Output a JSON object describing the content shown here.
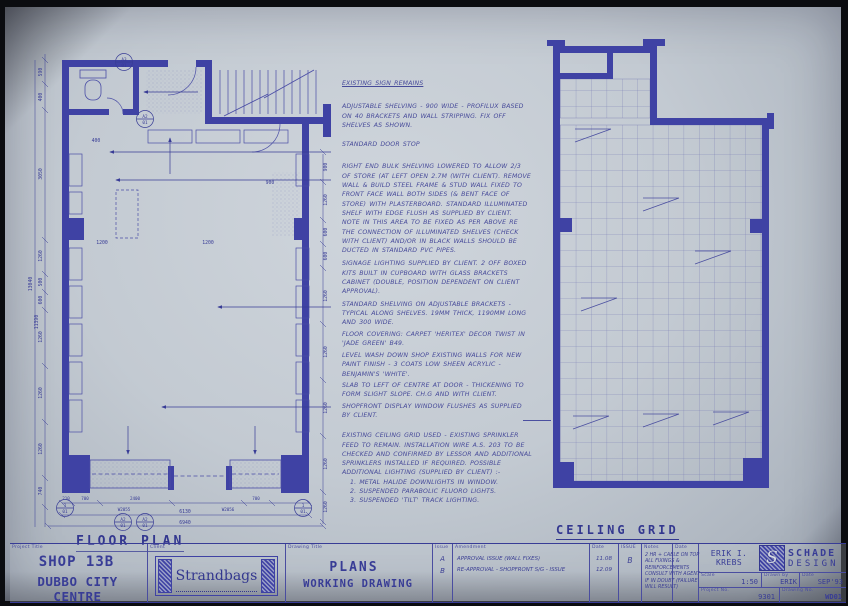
{
  "sheet": {
    "paper_color": "#c3cad2",
    "ink_color": "#383c96",
    "wall_color": "#3f42a4"
  },
  "floor_plan": {
    "title": "FLOOR PLAN",
    "dims_left": [
      "590",
      "400",
      "3050",
      "1260",
      "500",
      "600",
      "1260",
      "1260",
      "1260",
      "740"
    ],
    "dims_left_totals": [
      "13040",
      "11390"
    ],
    "dims_right": [
      "900",
      "1260",
      "600",
      "600",
      "1260",
      "1260",
      "1260",
      "1260",
      "1260"
    ],
    "dims_bottom": [
      "210",
      "700",
      "2400",
      "700"
    ],
    "dims_bottom_totals": [
      "6130",
      "6940"
    ],
    "window_tags": [
      "W2055",
      "W2056"
    ],
    "interior_dims": {
      "d1200a": "1200",
      "d1200b": "1200",
      "d900": "900",
      "d400": "400"
    },
    "ref_tags": {
      "a3": "A3",
      "a2": "A2",
      "one": "1",
      "sheet_no": "01"
    }
  },
  "ceiling_grid": {
    "title": "CEILING GRID"
  },
  "notes": {
    "items": [
      "EXISTING SIGN REMAINS",
      "ADJUSTABLE SHELVING - 900 WIDE - PROFILUX BASED ON 40 BRACKETS AND WALL STRIPPING. FIX OFF SHELVES AS SHOWN.",
      "STANDARD DOOR STOP",
      "RIGHT END BULK SHELVING LOWERED TO ALLOW 2/3 OF STORE (AT LEFT OPEN 2.7M (WITH CLIENT). REMOVE WALL & BUILD STEEL FRAME & STUD WALL FIXED TO FRONT FACE WALL BOTH SIDES (& BENT FACE OF STORE) WITH PLASTERBOARD. STANDARD ILLUMINATED SHELF WITH EDGE FLUSH AS SUPPLIED BY CLIENT. NOTE IN THIS AREA TO BE FIXED AS PER ABOVE RE THE CONNECTION OF ILLUMINATED SHELVES (CHECK WITH CLIENT) AND/OR IN BLACK WALLS SHOULD BE DUCTED IN STANDARD PVC PIPES.",
      "SIGNAGE LIGHTING SUPPLIED BY CLIENT. 2 OFF BOXED KITS BUILT IN CUPBOARD WITH GLASS BRACKETS CABINET (DOUBLE, POSITION DEPENDENT ON CLIENT APPROVAL).",
      "STANDARD SHELVING ON ADJUSTABLE BRACKETS - TYPICAL ALONG SHELVES. 19MM THICK, 1190MM LONG AND 300 WIDE.",
      "FLOOR COVERING: CARPET 'HERITEX' DECOR TWIST IN 'JADE GREEN' B49.",
      "LEVEL WASH DOWN SHOP EXISTING WALLS FOR NEW PAINT FINISH - 3 COATS LOW SHEEN ACRYLIC - BENJAMIN'S 'WHITE'.",
      "SLAB TO LEFT OF CENTRE AT DOOR - THICKENING TO FORM SLIGHT SLOPE. CH.G AND WITH CLIENT.",
      "SHOPFRONT DISPLAY WINDOW FLUSHES AS SUPPLIED BY CLIENT.",
      "EXISTING CEILING GRID USED - EXISTING SPRINKLER FEED TO REMAIN. INSTALLATION WIRE A.S. 203 TO BE CHECKED AND CONFIRMED BY LESSOR AND ADDITIONAL SPRINKLERS INSTALLED IF REQUIRED. POSSIBLE ADDITIONAL LIGHTING (SUPPLIED BY CLIENT) :-",
      "1. METAL HALIDE DOWNLIGHTS IN WINDOW.",
      "2. SUSPENDED PARABOLIC FLUORO LIGHTS.",
      "3. SUSPENDED 'TILT' TRACK LIGHTING."
    ]
  },
  "title_block": {
    "project_title_label": "Project Title",
    "project_title_line1": "SHOP  13B",
    "project_title_line2": "DUBBO CITY CENTRE",
    "client_label": "Client",
    "client_name": "Strandbags",
    "drawing_title_label": "Drawing Title",
    "drawing_title_line1": "PLANS",
    "drawing_title_line2": "WORKING DRAWING",
    "issue_label": "Issue",
    "amendment_label": "Amendment",
    "date_label": "Date",
    "issue2_label": "ISSUE",
    "notes_label": "Notes",
    "date2_label": "Date",
    "revisions": [
      {
        "issue": "A",
        "amendment": "APPROVAL ISSUE (WALL FIXES)",
        "date": "11.08"
      },
      {
        "issue": "B",
        "amendment": "RE-APPROVAL - SHOPFRONT S/G - ISSUE",
        "date": "12.09"
      }
    ],
    "issue_current": "B",
    "notes_text": "2 HR + CABLE ON TOP ALL FIXINGS & REINFORCEMENTS CONSULT WITH AGENT IF IN DOUBT (FAILURE WILL RESULT)",
    "designer_name": "ERIK I. KREBS",
    "studio_monogram": "S",
    "studio_line1": "SCHADE",
    "studio_line2": "DESIGN",
    "scale_label": "Scale",
    "scale_value": "1:50",
    "drawn_label": "Drawn by",
    "drawn_value": "ERIK",
    "date3_label": "Date",
    "date3_value": "SEP'93",
    "project_no_label": "Project No.",
    "project_no_value": "9301",
    "drawing_no_label": "Drawing No.",
    "drawing_no_value": "WD01"
  }
}
